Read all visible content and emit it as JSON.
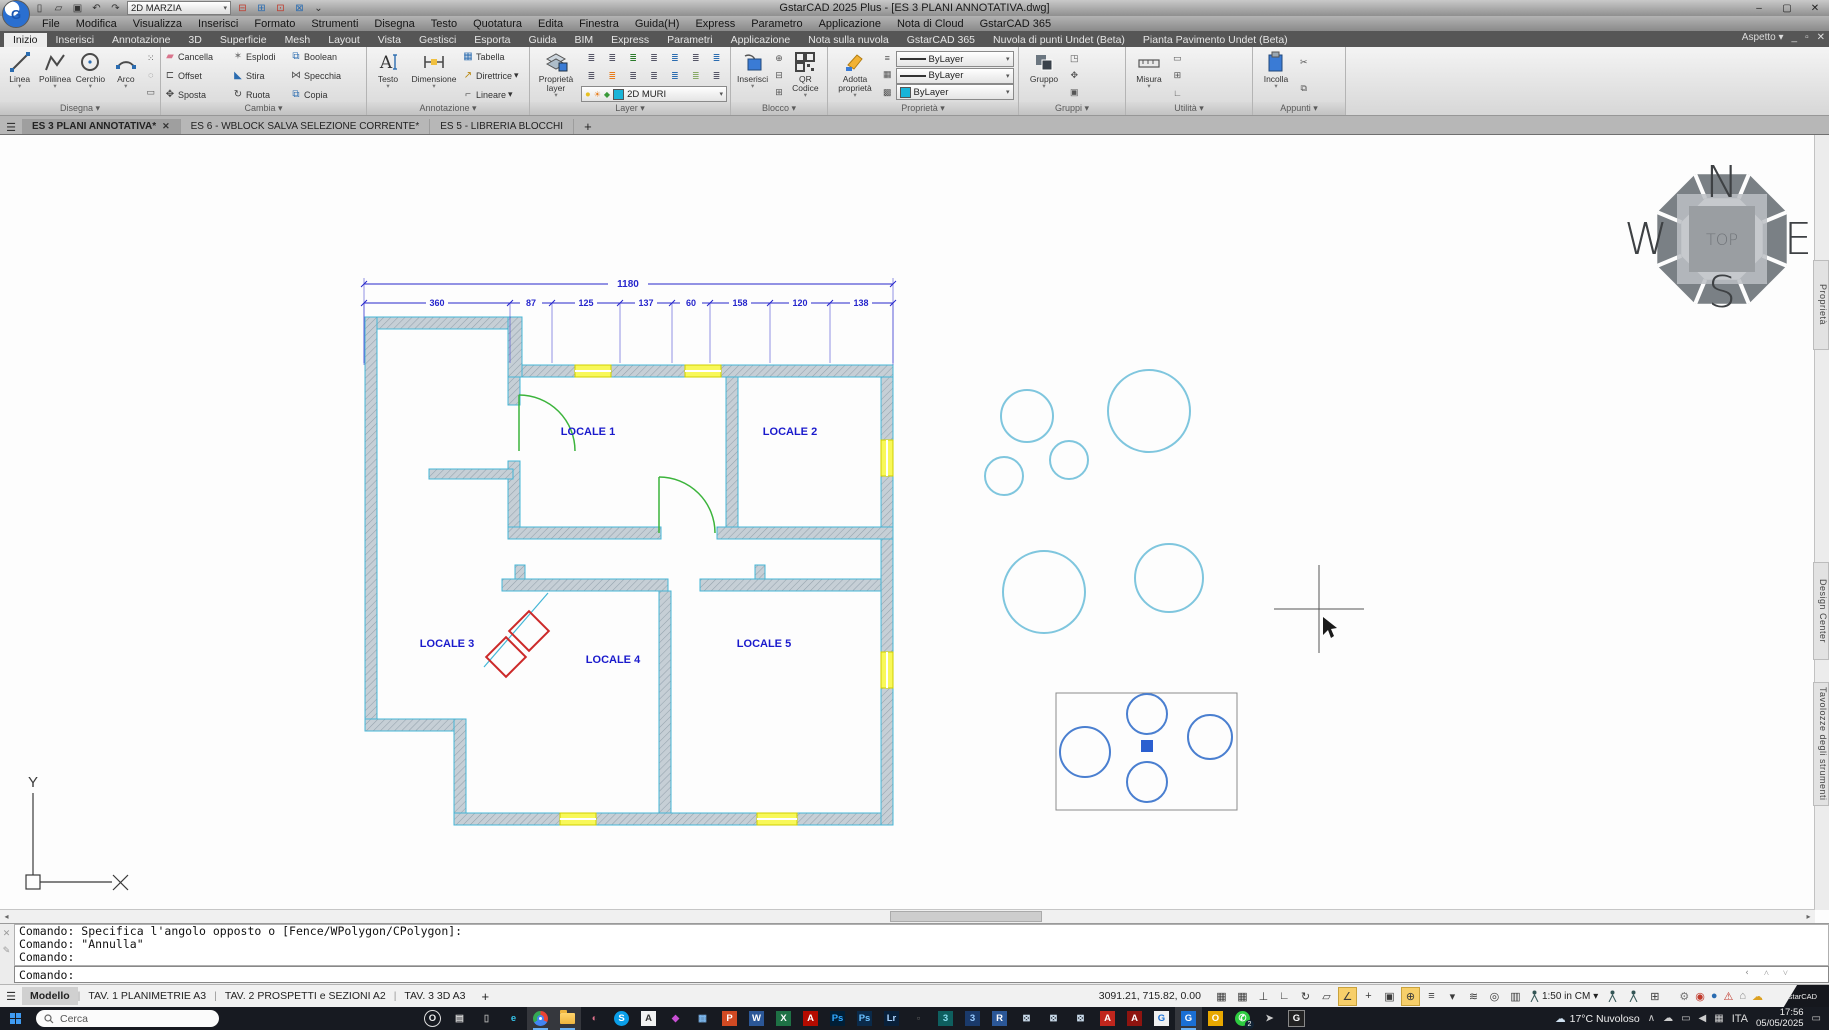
{
  "window": {
    "title": "GstarCAD 2025 Plus - [ES 3 PLANI ANNOTATIVA.dwg]"
  },
  "qat": {
    "workspace": "2D MARZIA",
    "icons": [
      "new-file-icon",
      "open-file-icon",
      "save-file-icon",
      "undo-icon",
      "redo-icon"
    ],
    "right_icons": [
      "xref-icon",
      "layer-translate-icon",
      "layer-state-icon",
      "block-edit-icon",
      "customize-icon"
    ]
  },
  "menu": {
    "items": [
      "File",
      "Modifica",
      "Visualizza",
      "Inserisci",
      "Formato",
      "Strumenti",
      "Disegna",
      "Testo",
      "Quotatura",
      "Edita",
      "Finestra",
      "Guida(H)",
      "Express",
      "Parametro",
      "Applicazione",
      "Nota di Cloud",
      "GstarCAD 365"
    ]
  },
  "ribbon": {
    "aspetto": "Aspetto",
    "tabs": [
      {
        "label": "Inizio",
        "active": true
      },
      {
        "label": "Inserisci"
      },
      {
        "label": "Annotazione"
      },
      {
        "label": "3D"
      },
      {
        "label": "Superficie"
      },
      {
        "label": "Mesh"
      },
      {
        "label": "Layout"
      },
      {
        "label": "Vista"
      },
      {
        "label": "Gestisci"
      },
      {
        "label": "Esporta"
      },
      {
        "label": "Guida"
      },
      {
        "label": "BIM"
      },
      {
        "label": "Express"
      },
      {
        "label": "Parametri"
      },
      {
        "label": "Applicazione"
      },
      {
        "label": "Nota sulla nuvola"
      },
      {
        "label": "GstarCAD 365"
      },
      {
        "label": "Nuvola di punti Undet (Beta)"
      },
      {
        "label": "Pianta Pavimento Undet (Beta)"
      }
    ],
    "panels": [
      {
        "label": "Disegna",
        "big": [
          "Linea",
          "Polilinea",
          "Cerchio",
          "Arco"
        ]
      },
      {
        "label": "Cambia",
        "grid": [
          [
            "Cancella",
            "Esplodi",
            "Boolean"
          ],
          [
            "Offset",
            "Stira",
            "Specchia"
          ],
          [
            "Sposta",
            "Ruota",
            "Copia"
          ]
        ]
      },
      {
        "label": "Annotazione",
        "big": [
          "Testo",
          "Dimensione"
        ],
        "col": [
          "Tabella",
          "Direttrice",
          "Lineare"
        ]
      },
      {
        "label": "Layer",
        "big": [
          "Proprietà layer"
        ],
        "layer_combo": "2D MURI"
      },
      {
        "label": "Blocco",
        "big": [
          "Inserisci",
          "QR Codice"
        ]
      },
      {
        "label": "Proprietà",
        "big": [
          "Adotta proprietà"
        ],
        "combos": [
          "ByLayer",
          "ByLayer",
          "ByLayer"
        ]
      },
      {
        "label": "Gruppi",
        "big": [
          "Gruppo"
        ]
      },
      {
        "label": "Utilità",
        "big": [
          "Misura"
        ]
      },
      {
        "label": "Appunti",
        "big": [
          "Incolla"
        ]
      }
    ]
  },
  "doc_tabs": {
    "tabs": [
      {
        "label": "ES 3 PLANI ANNOTATIVA*",
        "active": true,
        "closable": true
      },
      {
        "label": "ES 6 - WBLOCK SALVA SELEZIONE CORRENTE*"
      },
      {
        "label": "ES 5 - LIBRERIA BLOCCHI"
      }
    ],
    "add": "+"
  },
  "canvas": {
    "rooms": [
      "LOCALE 1",
      "LOCALE 2",
      "LOCALE 3",
      "LOCALE 4",
      "LOCALE 5"
    ],
    "dim_total": "1180",
    "dims": [
      "360",
      "87",
      "125",
      "137",
      "60",
      "158",
      "120",
      "138"
    ],
    "viewcube": {
      "n": "N",
      "e": "E",
      "s": "S",
      "w": "W",
      "top": "TOP"
    },
    "side_tabs": [
      "Proprietà",
      "Design Center",
      "Tavolozze degli strumenti"
    ],
    "ucs_y": "Y"
  },
  "command_line": {
    "history": [
      "Comando: Specifica l'angolo opposto o [Fence/WPolygon/CPolygon]:",
      "Comando: \"Annulla\"",
      "Comando:"
    ],
    "prompt": "Comando:"
  },
  "status_bar": {
    "layout_tabs": [
      {
        "label": "Modello",
        "active": true
      },
      {
        "label": "TAV. 1 PLANIMETRIE A3"
      },
      {
        "label": "TAV. 2 PROSPETTI e SEZIONI A2"
      },
      {
        "label": "TAV. 3 3D A3"
      }
    ],
    "add": "+",
    "coords": "3091.21, 715.82, 0.00",
    "scale": "1:50 in CM",
    "toggles": [
      {
        "name": "grid-display-icon"
      },
      {
        "name": "snap-mode-icon"
      },
      {
        "name": "polar-snap-icon"
      },
      {
        "name": "ortho-mode-icon"
      },
      {
        "name": "polar-tracking-icon"
      },
      {
        "name": "dynamic-ucs-icon"
      },
      {
        "name": "object-snap-icon",
        "active": true
      },
      {
        "name": "object-snap-tracking-icon"
      },
      {
        "name": "lineweight-display-icon"
      },
      {
        "name": "dynamic-input-icon",
        "active": true
      },
      {
        "name": "quick-properties-icon"
      },
      {
        "name": "annotation-visibility-icon"
      },
      {
        "name": "annotation-autoscale-icon"
      },
      {
        "name": "zoom-tool-icon"
      },
      {
        "name": "clean-screen-icon"
      }
    ],
    "settings_icons": [
      "settings-gear-icon",
      "security-lock-icon",
      "share-icon",
      "alert-icon",
      "home-icon",
      "cloud-sync-icon"
    ],
    "logo": "GstarCAD"
  },
  "taskbar": {
    "search": "Cerca",
    "apps": [
      {
        "name": "opera",
        "text": "O"
      },
      {
        "name": "task-view",
        "text": ""
      },
      {
        "name": "phone-link",
        "text": ""
      },
      {
        "name": "edge",
        "text": "e"
      },
      {
        "name": "chrome",
        "text": "",
        "active": true
      },
      {
        "name": "file-explorer",
        "text": "",
        "active": true
      },
      {
        "name": "paint-app",
        "text": ""
      },
      {
        "name": "skype",
        "text": "S"
      },
      {
        "name": "notes-app",
        "text": "A"
      },
      {
        "name": "color-picker",
        "text": ""
      },
      {
        "name": "calculator",
        "text": ""
      },
      {
        "name": "powerpoint",
        "text": "P"
      },
      {
        "name": "word",
        "text": "W"
      },
      {
        "name": "excel",
        "text": "X"
      },
      {
        "name": "adobe-app",
        "text": "A"
      },
      {
        "name": "photoshop",
        "text": "Ps"
      },
      {
        "name": "photoshop-beta",
        "text": "Ps"
      },
      {
        "name": "lightroom",
        "text": "Lr"
      },
      {
        "name": "hidden-app",
        "text": ""
      },
      {
        "name": "3ds-max",
        "text": "3"
      },
      {
        "name": "app-3-blue",
        "text": "3"
      },
      {
        "name": "revit",
        "text": "R"
      },
      {
        "name": "cad-toolset-1",
        "text": ""
      },
      {
        "name": "cad-toolset-2",
        "text": ""
      },
      {
        "name": "cad-toolset-3",
        "text": ""
      },
      {
        "name": "autocad",
        "text": "A"
      },
      {
        "name": "autocad-lt",
        "text": "A"
      },
      {
        "name": "gstarcad",
        "text": "G"
      },
      {
        "name": "gstarcad-2025",
        "text": "G",
        "active": true
      },
      {
        "name": "office-hub",
        "text": "O"
      },
      {
        "name": "whatsapp",
        "text": "",
        "badge": "2"
      },
      {
        "name": "media-app",
        "text": ""
      },
      {
        "name": "gstarcad-tools",
        "text": "G"
      }
    ],
    "tray": {
      "weather": "17°C Nuvoloso",
      "lang": "ITA",
      "time": "17:56",
      "date": "05/05/2025"
    }
  }
}
